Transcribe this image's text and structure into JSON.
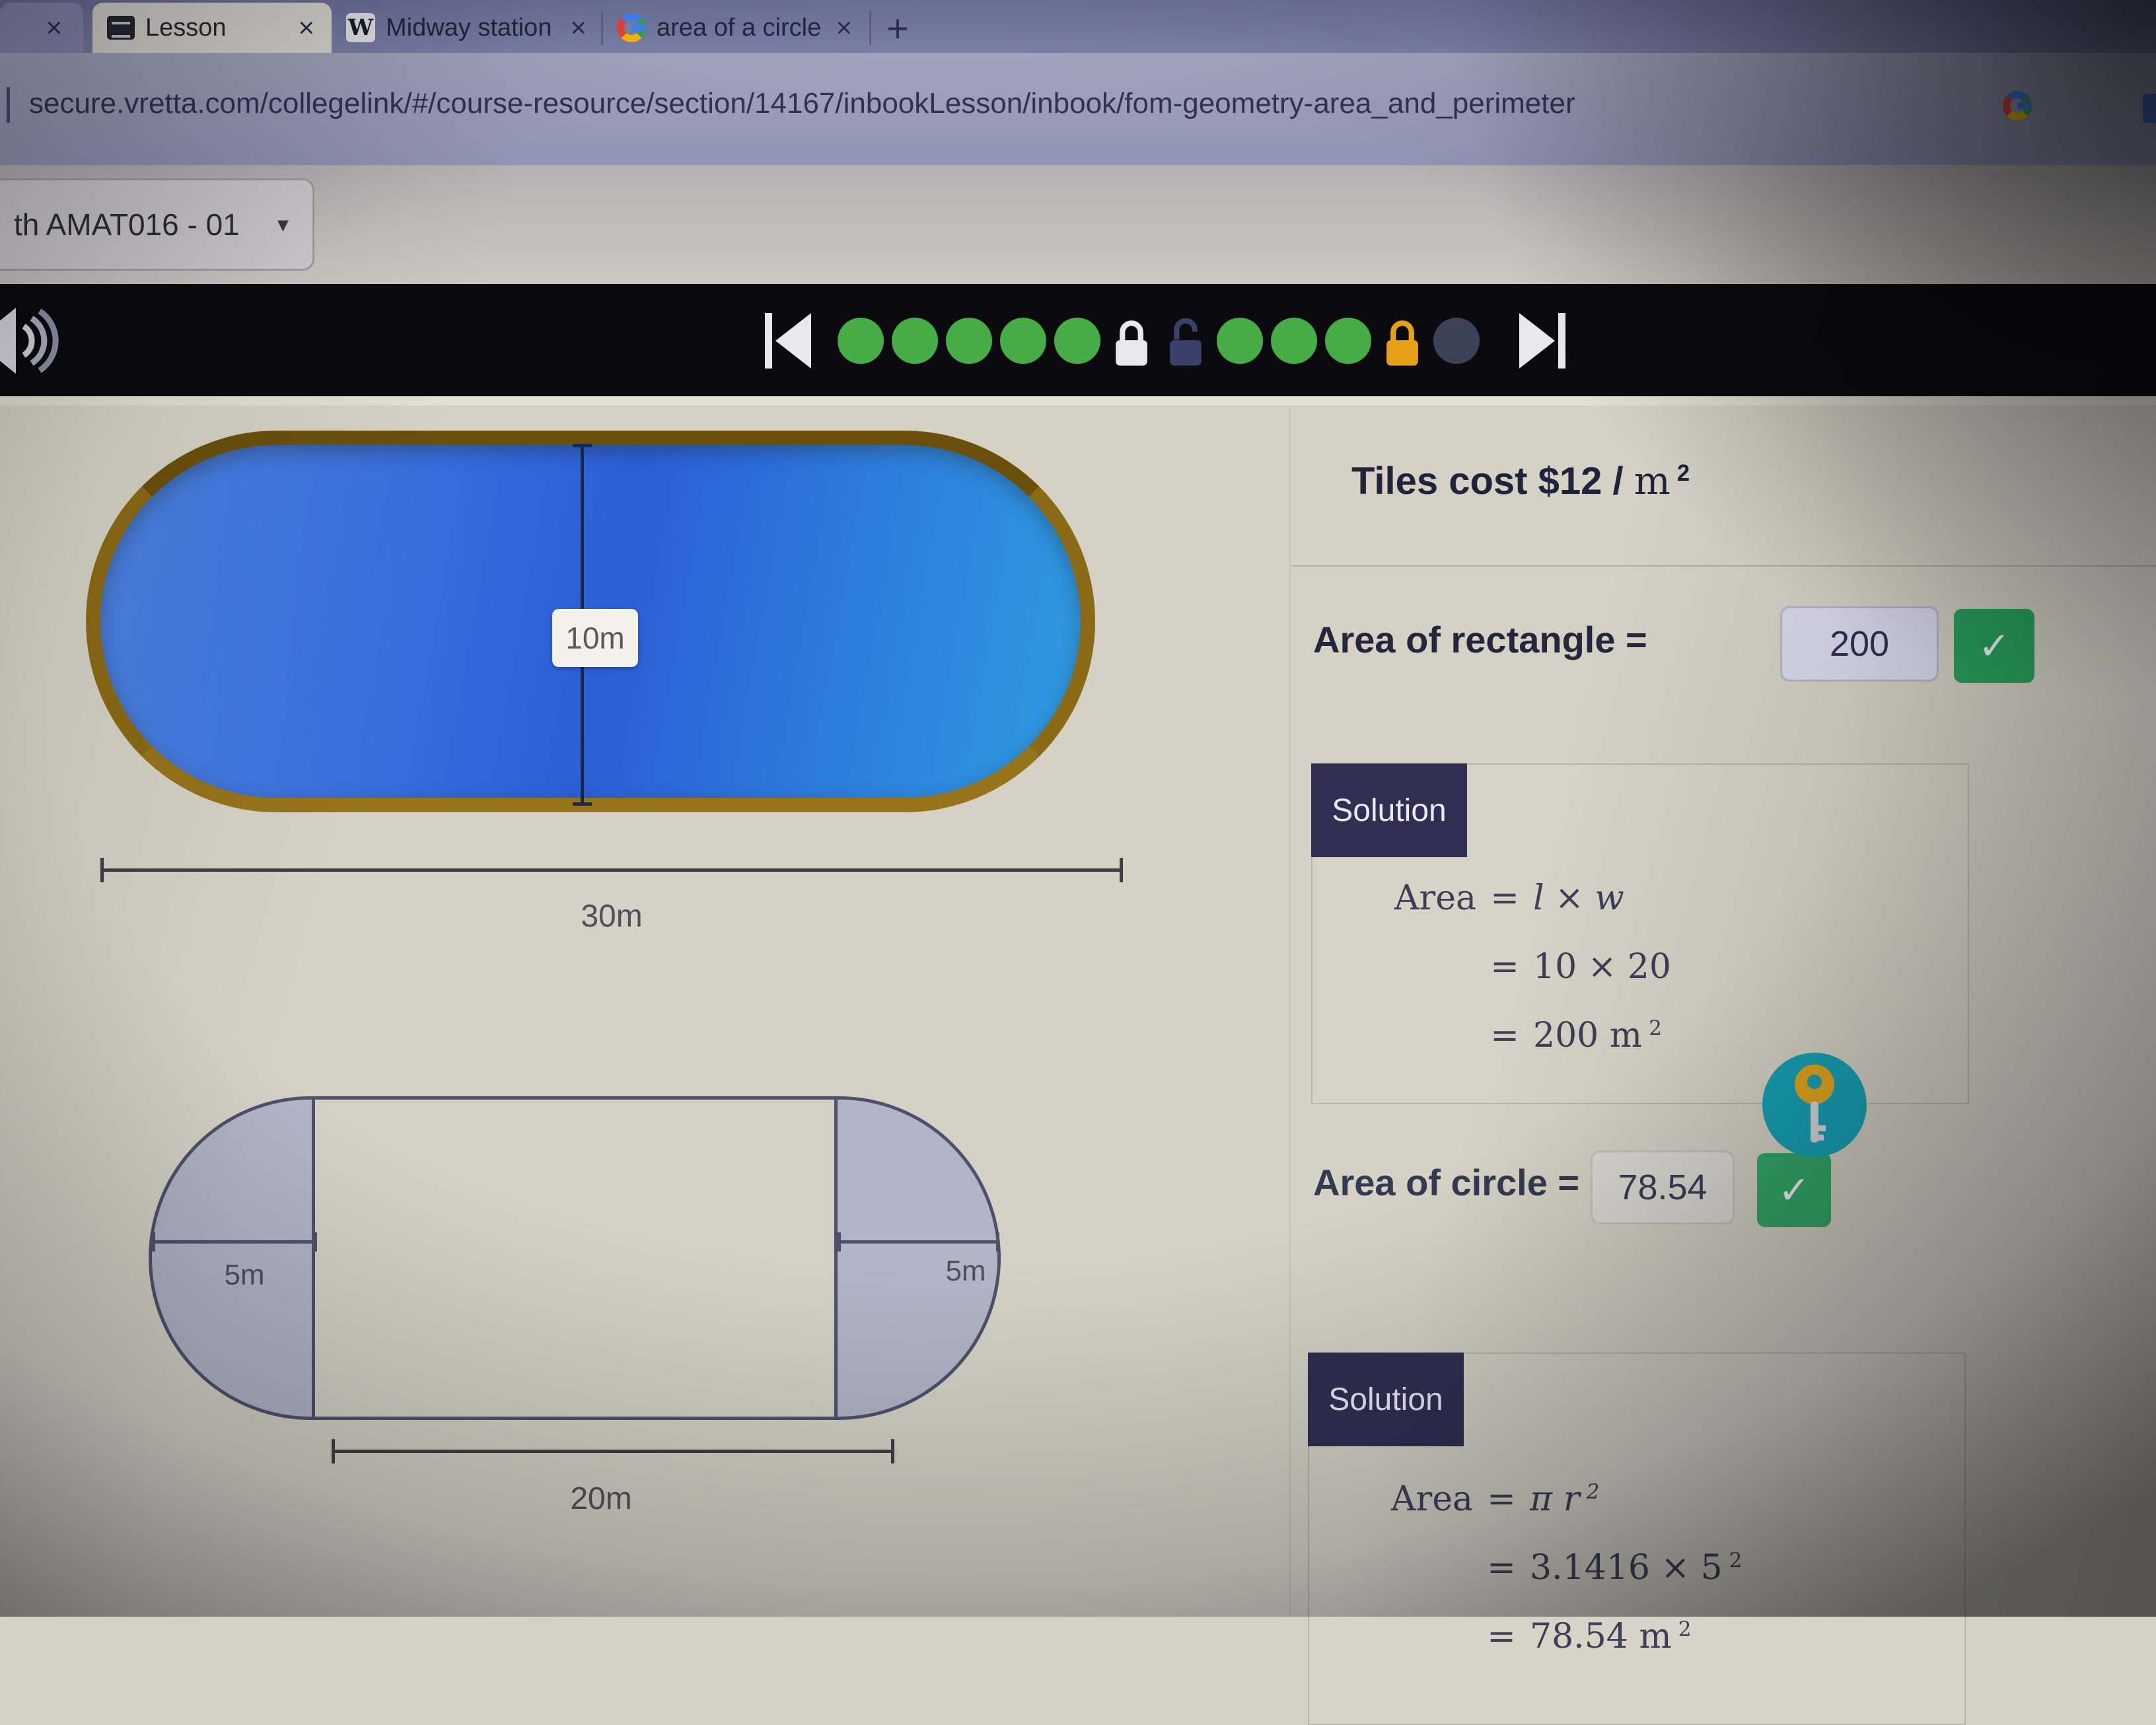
{
  "browser": {
    "close_glyph": "×",
    "new_tab_glyph": "+",
    "tabs": {
      "lesson": {
        "label": "Lesson"
      },
      "wikipedia": {
        "label": "Midway station (CTA) - Wikipedia",
        "favicon_glyph": "W"
      },
      "google": {
        "label": "area of a circle - Google Search"
      }
    },
    "url": "secure.vretta.com/collegelink/#/course-resource/section/14167/inbookLesson/inbook/fom-geometry-area_and_perimeter"
  },
  "course_header": {
    "dropdown_label": "th AMAT016 - 01",
    "caret_glyph": "▾"
  },
  "player_bar": {
    "dots": [
      "green",
      "green",
      "green",
      "green",
      "green",
      "lock-closed-white",
      "lock-open-dark",
      "green",
      "green",
      "green",
      "lock-closed-orange",
      "inactive"
    ]
  },
  "figures": {
    "pool": {
      "width_label": "10m",
      "length_label": "30m"
    },
    "stadium": {
      "left_radius_label": "5m",
      "right_radius_label": "5m",
      "rect_length_label": "20m"
    }
  },
  "questions": {
    "tiles_cost_prefix": "Tiles cost $12 / ",
    "tiles_cost_unit": "m",
    "tiles_cost_sup": "2",
    "rect_label": "Area of rectangle =",
    "rect_value": "200",
    "circle_label": "Area of circle =",
    "circle_value": "78.54"
  },
  "icons": {
    "check_glyph": "✓"
  },
  "solutions": [
    {
      "title": "Solution",
      "rows": [
        {
          "lhs": "Area",
          "eq": "=",
          "rhs": "l × w",
          "italic": true
        },
        {
          "lhs": "",
          "eq": "=",
          "rhs": "10 × 20"
        },
        {
          "lhs": "",
          "eq": "=",
          "rhs": "200 m",
          "sup": "2"
        }
      ]
    },
    {
      "title": "Solution",
      "rows": [
        {
          "lhs": "Area",
          "eq": "=",
          "rhs": "π r",
          "sup": "2",
          "italic": true
        },
        {
          "lhs": "",
          "eq": "=",
          "rhs": "3.1416 × 5",
          "sup": "2"
        },
        {
          "lhs": "",
          "eq": "=",
          "rhs": "78.54 m",
          "sup": "2"
        }
      ]
    }
  ],
  "colors": {
    "dot_green": "#46ad46",
    "lock_white": "#e8e8ee",
    "lock_open_dark": "#39406a",
    "lock_orange": "#e8a017",
    "accent_green": "#28a25b",
    "solution_navy": "#302e52",
    "pool_border_brown": "#8a6a14",
    "pool_blue": "#2b5fd6",
    "key_teal": "#16a4b6",
    "key_gold": "#e7a71d"
  }
}
